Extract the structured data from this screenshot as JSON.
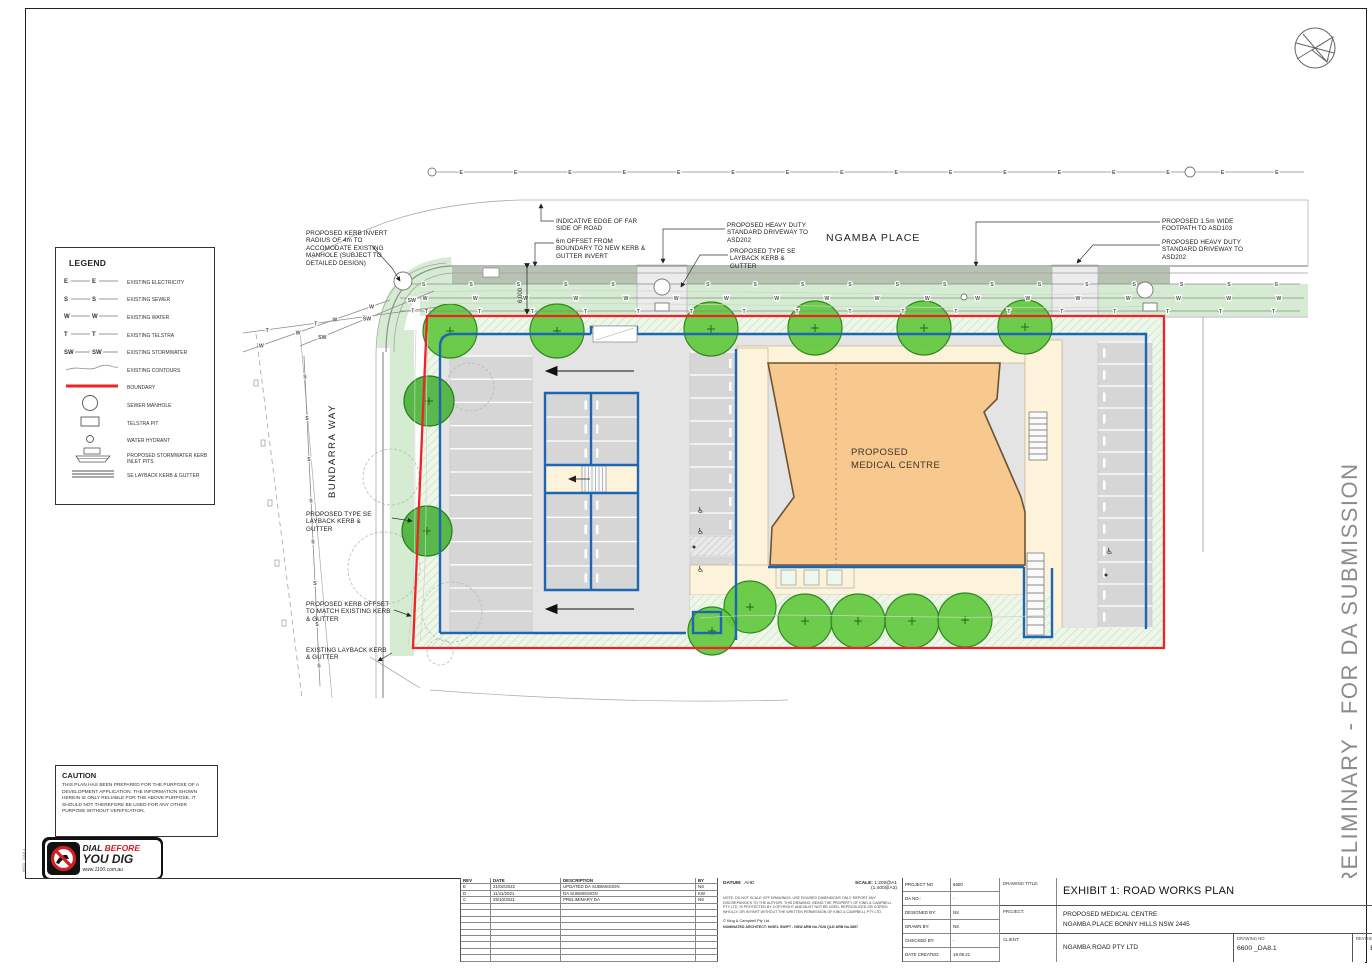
{
  "sheet": {
    "preliminary_banner": "PRELIMINARY - FOR DA SUBMISSION",
    "sheet_size": "A1",
    "file_ref": "6600 _DA8.1"
  },
  "legend": {
    "title": "LEGEND",
    "items": [
      {
        "code": "E",
        "type": "utility",
        "label": "EXISTING ELECTRICITY"
      },
      {
        "code": "S",
        "type": "utility",
        "label": "EXISTING SEWER"
      },
      {
        "code": "W",
        "type": "utility",
        "label": "EXISTING WATER"
      },
      {
        "code": "T",
        "type": "utility",
        "label": "EXISTING TELSTRA"
      },
      {
        "code": "SW",
        "type": "utility",
        "label": "EXISTING STORMWATER"
      },
      {
        "code": "",
        "type": "contour",
        "label": "EXISTING CONTOURS"
      },
      {
        "code": "",
        "type": "boundary",
        "label": "BOUNDARY"
      },
      {
        "code": "",
        "type": "manhole",
        "label": "SEWER MANHOLE"
      },
      {
        "code": "",
        "type": "telstra",
        "label": "TELSTRA PIT"
      },
      {
        "code": "",
        "type": "hydrant",
        "label": "WATER HYDRANT"
      },
      {
        "code": "",
        "type": "inlet",
        "label": "PROPOSED STORMWATER KERB INLET PITS"
      },
      {
        "code": "",
        "type": "layback",
        "label": "SE LAYBACK KERB & GUTTER"
      }
    ]
  },
  "plan": {
    "street_top": "NGAMBA PLACE",
    "street_left": "BUNDARRA WAY",
    "building_label_line1": "PROPOSED",
    "building_label_line2": "MEDICAL CENTRE",
    "offset_dimension": "6,000",
    "annotations": {
      "kerb_invert": "PROPOSED KERB INVERT RADIUS OF 4m TO ACCOMODATE EXISTING MANHOLE (SUBJECT TO DETAILED DESIGN)",
      "far_edge": "INDICATIVE EDGE OF FAR SIDE OF ROAD",
      "offset_6m": "6m OFFSET FROM BOUNDARY TO NEW KERB & GUTTER INVERT",
      "hd_driveway_left": "PROPOSED HEAVY DUTY STANDARD DRIVEWAY TO ASD202",
      "layback_top": "PROPOSED TYPE SE LAYBACK KERB & GUTTER",
      "footpath_right": "PROPOSED 1.5m WIDE FOOTPATH TO ASD103",
      "hd_driveway_right": "PROPOSED HEAVY DUTY STANDARD DRIVEWAY TO ASD202",
      "layback_left": "PROPOSED TYPE SE LAYBACK KERB & GUTTER",
      "kerb_offset": "PROPOSED KERB OFFSET TO MATCH EXISTING KERB & GUTTER",
      "existing_layback": "EXISTING LAYBACK KERB & GUTTER"
    },
    "colors": {
      "boundary_red": "#ee2327",
      "kerb_blue": "#1d67b2",
      "building_fill": "#f8c98f",
      "tree_green": "#62c83e",
      "tree_dark": "#4cb33c",
      "verge_green": "#d6ecd2",
      "footpath_gray": "#b7c2b2",
      "carpark_gray": "#e4e4e4",
      "bay_gray": "#d6d6d6",
      "cream": "#fdf3da"
    },
    "utility_lines": [
      {
        "letter": "E",
        "x1": 434,
        "y1": 172,
        "x2": 1304,
        "y2": 172,
        "n": 16
      },
      {
        "letter": "S",
        "x1": 400,
        "y1": 284,
        "x2": 1300,
        "y2": 284,
        "n": 19
      },
      {
        "letter": "W",
        "x1": 400,
        "y1": 298,
        "x2": 1304,
        "y2": 298,
        "n": 18
      },
      {
        "letter": "T",
        "x1": 400,
        "y1": 311,
        "x2": 1300,
        "y2": 311,
        "n": 17
      },
      {
        "letter": "S",
        "x1": 304,
        "y1": 356,
        "x2": 320,
        "y2": 686,
        "n": 8
      },
      {
        "letter": "W",
        "x1": 243,
        "y1": 352,
        "x2": 390,
        "y2": 300,
        "n": 4
      },
      {
        "letter": "T",
        "x1": 243,
        "y1": 333,
        "x2": 437,
        "y2": 307,
        "n": 4
      },
      {
        "letter": "SW",
        "x1": 300,
        "y1": 346,
        "x2": 434,
        "y2": 291,
        "n": 3
      }
    ],
    "trees": [
      {
        "x": 450,
        "y": 331,
        "r": 27,
        "shade": "bright"
      },
      {
        "x": 557,
        "y": 331,
        "r": 27,
        "shade": "bright"
      },
      {
        "x": 711,
        "y": 329,
        "r": 27,
        "shade": "bright"
      },
      {
        "x": 815,
        "y": 328,
        "r": 27,
        "shade": "bright"
      },
      {
        "x": 924,
        "y": 328,
        "r": 27,
        "shade": "bright"
      },
      {
        "x": 1025,
        "y": 327,
        "r": 27,
        "shade": "bright"
      },
      {
        "x": 429,
        "y": 401,
        "r": 25,
        "shade": "dark"
      },
      {
        "x": 427,
        "y": 531,
        "r": 25,
        "shade": "dark"
      },
      {
        "x": 750,
        "y": 607,
        "r": 26,
        "shade": "bright"
      },
      {
        "x": 712,
        "y": 631,
        "r": 24,
        "shade": "bright"
      },
      {
        "x": 805,
        "y": 621,
        "r": 27,
        "shade": "bright"
      },
      {
        "x": 858,
        "y": 621,
        "r": 27,
        "shade": "bright"
      },
      {
        "x": 912,
        "y": 621,
        "r": 27,
        "shade": "bright"
      },
      {
        "x": 965,
        "y": 620,
        "r": 27,
        "shade": "bright"
      }
    ],
    "parking_columns": [
      {
        "x": 450,
        "y": 356,
        "w": 82,
        "rows": 12,
        "rowH": 23.2,
        "stop": 0
      },
      {
        "x": 545,
        "y": 393,
        "w": 93,
        "rows": 3,
        "rowH": 24,
        "stop": -1
      },
      {
        "x": 545,
        "y": 493,
        "w": 93,
        "rows": 4,
        "rowH": 24.3,
        "stop": -1
      },
      {
        "x": 690,
        "y": 352,
        "w": 47,
        "rows": 8,
        "rowH": 23,
        "stop": 729
      },
      {
        "x": 690,
        "y": 556,
        "w": 47,
        "rows": 3,
        "rowH": 24,
        "stop": 729
      },
      {
        "x": 1098,
        "y": 342,
        "w": 54,
        "rows": 13,
        "rowH": 22,
        "stop": 1103
      }
    ],
    "accessible_spots": [
      [
        697,
        513
      ],
      [
        697,
        534
      ],
      [
        697,
        572
      ],
      [
        1106,
        554
      ]
    ]
  },
  "caution": {
    "title": "CAUTION",
    "body": "THIS PLAN HAS BEEN PREPARED FOR THE PURPOSE OF A DEVELOPMENT APPLICATION. THE INFORMATION SHOWN HEREIN IS ONLY RELIABLE FOR THE ABOVE PURPOSE. IT SHOULD NOT THEREFORE BE USED FOR ANY OTHER PURPOSE WITHOUT VERIFICATION."
  },
  "dig_logo": {
    "word1": "DIAL",
    "word2": "BEFORE",
    "line2": "YOU DIG",
    "url": "www.1100.com.au"
  },
  "firm": {
    "name_left": "KING",
    "plus": "+",
    "name_right": "CAMPBELL",
    "contact": [
      "King & Campbell Pty Ltd",
      "www.KingCampbell.com.au",
      "A. PO Box 243 Port Macquarie NSW 2444",
      "T: 02 6586 2555",
      "F: 02 6583 4064",
      "E: info@KingCampbell.com.au"
    ]
  },
  "titleblock": {
    "rev_headers": [
      "REV",
      "DATE",
      "DESCRIPTION",
      "BY"
    ],
    "revisions": [
      {
        "rev": "E",
        "date": "21/02/2022",
        "desc": "UPDATED DA SUBMISSION",
        "by": "NS"
      },
      {
        "rev": "D",
        "date": "11/11/2021",
        "desc": "DA SUBMISSION",
        "by": "KW"
      },
      {
        "rev": "C",
        "date": "25/10/2021",
        "desc": "PRELIMINARY DA",
        "by": "NS"
      }
    ],
    "empty_rows": 9,
    "datum_label": "DATUM:",
    "datum": "AHD",
    "scale_label": "SCALE:",
    "scale": "1:200@A1",
    "scale2": "(1:400@A3)",
    "note": "NOTE: DO NOT SCALE OFF DRAWINGS. USE FIGURED DIMENSIONS ONLY. REPORT ANY DISCREPANCIES TO THE AUTHOR. THIS DRAWING, BEING THE PROPERTY OF KING & CAMPBELL PTY LTD, IS PROTECTED BY COPYRIGHT AND MUST NOT BE USED, REPRODUCED OR COPIED WHOLLY, OR IN PART WITHOUT THE WRITTEN PERMISSION OF KING & CAMPBELL PTY LTD.",
    "copyright": "© King & Campbell Pty Ltd",
    "architect": "NOMINATED ARCHITECT:  NIGEL SWIFT - NSW ARB No.7028 QLD ARB No.3857",
    "fields": [
      {
        "label": "PROJECT NO",
        "value": "6600"
      },
      {
        "label": "DA NO.:",
        "value": "-"
      },
      {
        "label": "DESIGNED BY:",
        "value": "NS"
      },
      {
        "label": "DRAWN BY:",
        "value": "NS"
      },
      {
        "label": "CHECKED BY:",
        "value": "-"
      },
      {
        "label": "DATE CREATED:",
        "value": "19.09.21"
      }
    ],
    "drawing_title_label": "DRAWING TITLE:",
    "drawing_title": "EXHIBIT 1: ROAD WORKS PLAN",
    "project_label": "PROJECT:",
    "project_line1": "PROPOSED MEDICAL CENTRE",
    "project_line2": "NGAMBA PLACE BONNY HILLS NSW 2445",
    "client_label": "CLIENT:",
    "client": "NGAMBA ROAD PTY LTD",
    "drawing_no_label": "DRAWING NO",
    "drawing_no": "6600  _DA8.1",
    "revision_label": "REVISION",
    "revision": "E"
  }
}
